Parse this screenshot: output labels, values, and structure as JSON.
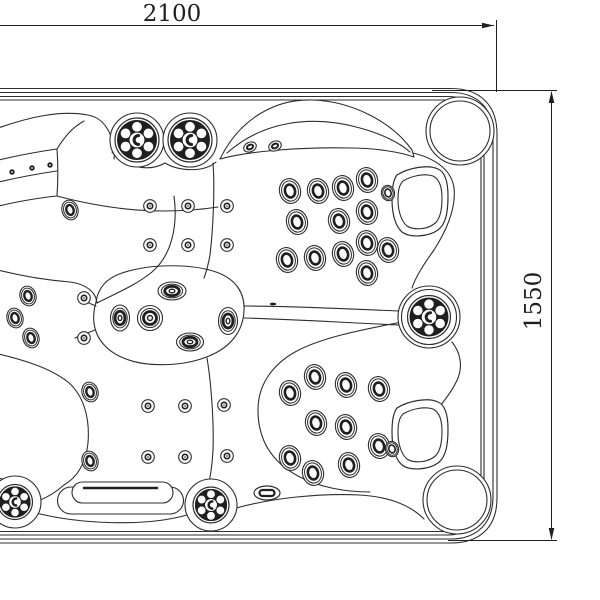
{
  "diagram": {
    "title": "Hot tub top view dimension drawing",
    "background": "#ffffff",
    "line_color": "#2d2d2d",
    "dark_color": "#1f1f1f",
    "width_dim": {
      "label": "2100"
    },
    "height_dim": {
      "label": "1550"
    },
    "star_jets": [
      {
        "x": 137,
        "y": 140,
        "r": 22,
        "pockets": [
          27
        ]
      },
      {
        "x": 190,
        "y": 140,
        "r": 22,
        "pockets": [
          27
        ]
      },
      {
        "x": 429,
        "y": 317,
        "r": 21.5,
        "pockets": [
          31,
          27.5
        ]
      },
      {
        "x": 15,
        "y": 502,
        "r": 17.5,
        "pockets": [
          26
        ]
      },
      {
        "x": 211,
        "y": 505,
        "r": 18,
        "pockets": [
          26
        ]
      }
    ],
    "cluster_jets": [
      [
        290,
        191
      ],
      [
        318,
        191
      ],
      [
        343,
        188
      ],
      [
        367,
        180
      ],
      [
        297,
        222
      ],
      [
        339,
        221
      ],
      [
        367,
        212
      ],
      [
        287,
        260
      ],
      [
        315,
        258
      ],
      [
        343,
        254
      ],
      [
        367,
        243
      ],
      [
        388,
        250
      ],
      [
        367,
        273
      ],
      [
        388,
        193,
        0.62
      ],
      [
        290,
        393
      ],
      [
        315,
        377
      ],
      [
        346,
        385
      ],
      [
        379,
        389
      ],
      [
        316,
        423
      ],
      [
        346,
        427
      ],
      [
        290,
        458
      ],
      [
        313,
        473
      ],
      [
        349,
        465
      ],
      [
        379,
        446
      ],
      [
        392,
        449,
        0.62
      ]
    ],
    "button_jets": [
      [
        150,
        206
      ],
      [
        188,
        206
      ],
      [
        227,
        206
      ],
      [
        150,
        245
      ],
      [
        188,
        245
      ],
      [
        227,
        245
      ],
      [
        84,
        298
      ],
      [
        84,
        338
      ],
      [
        148,
        406
      ],
      [
        185,
        406
      ],
      [
        224,
        405
      ],
      [
        148,
        457
      ],
      [
        185,
        457
      ],
      [
        227,
        456
      ]
    ],
    "ring_jets": [
      [
        70,
        210
      ],
      [
        28,
        296
      ],
      [
        15,
        318
      ],
      [
        31,
        338
      ],
      [
        90,
        392
      ],
      [
        90,
        461
      ]
    ],
    "island_jets": [
      {
        "x": 172,
        "y": 291,
        "rx": 14,
        "ry": 9
      },
      {
        "x": 120,
        "y": 318,
        "rx": 9.5,
        "ry": 13
      },
      {
        "x": 150,
        "y": 318,
        "rx": 12.5,
        "ry": 12.5
      },
      {
        "x": 228,
        "y": 321,
        "rx": 9.5,
        "ry": 13.5
      },
      {
        "x": 190,
        "y": 342,
        "rx": 13.5,
        "ry": 9
      }
    ],
    "pillow_jets": [
      [
        250,
        147
      ],
      [
        275,
        146
      ]
    ],
    "band_dots": [
      [
        12,
        172
      ],
      [
        32,
        168
      ],
      [
        50,
        165
      ]
    ],
    "drain": {
      "x": 267,
      "y": 493
    },
    "vent_mark": {
      "x": 273,
      "y": 304
    },
    "handles": [
      {
        "dx": 0,
        "dy": 0
      },
      {
        "dx": 0,
        "dy": 233
      }
    ],
    "corner_circles": [
      {
        "x": 460,
        "y": 131
      },
      {
        "x": 457,
        "y": 500
      }
    ]
  }
}
